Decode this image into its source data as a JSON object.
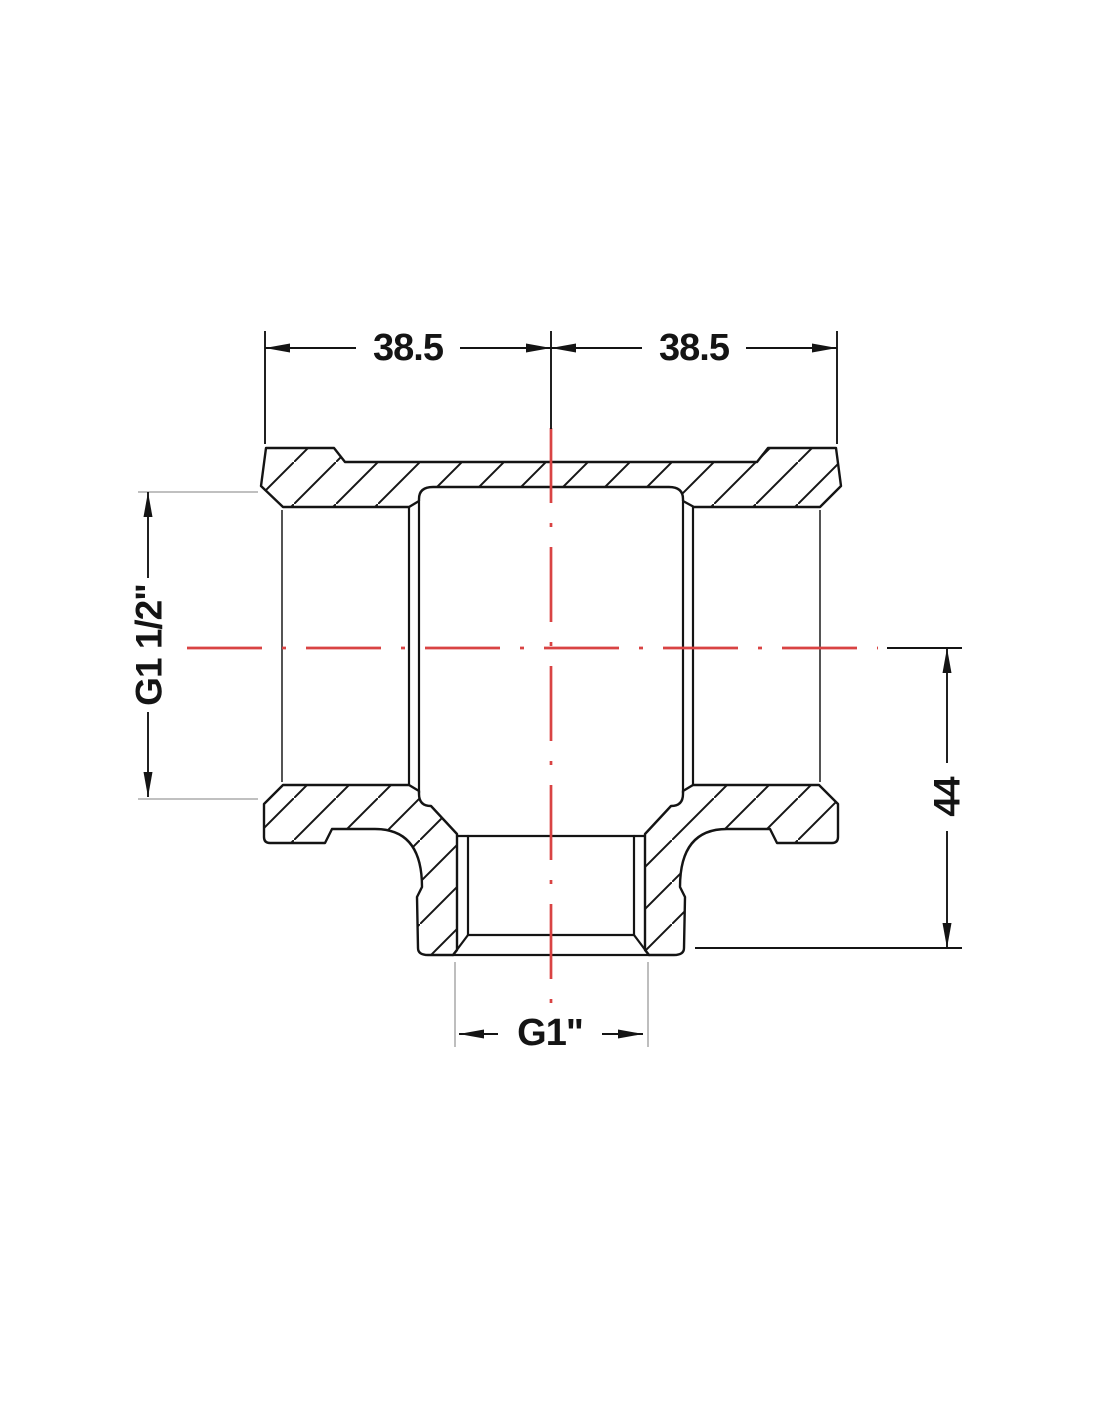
{
  "drawing": {
    "description": "Sectional technical drawing of a reducing tee pipe fitting (two G1 1/2 inch run ports, one G1 inch branch port)",
    "view": "full section, 45-degree hatching, dash-dot centerlines",
    "dimensions": {
      "top_left": "38.5",
      "top_right": "38.5",
      "left_port": "G1 1/2\"",
      "branch_height": "44",
      "bottom_port": "G1\""
    },
    "colors": {
      "outline": "#141414",
      "centerline": "#d94343",
      "extension_line": "#9b9b9b",
      "background": "#ffffff"
    }
  }
}
